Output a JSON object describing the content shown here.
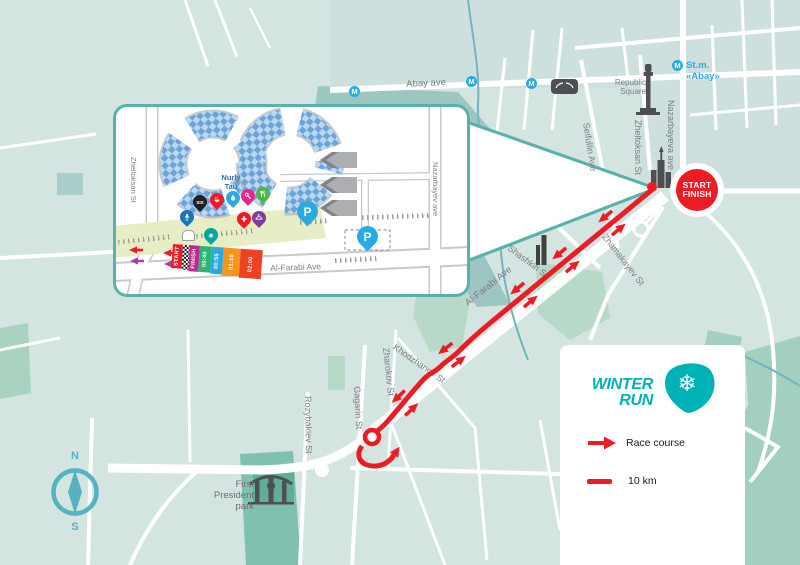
{
  "title": "Winter Run race course map",
  "colors": {
    "map_base": "#d3e4e1",
    "map_block": "#cde0dd",
    "lake": "#9dc5c2",
    "park_light_green": "#b7d9c8",
    "park_green": "#a3cfbf",
    "president_park": "#7fc1ae",
    "road": "#ffffff",
    "river": "#74b4c0",
    "inset_border_teal": "#57b2ad",
    "course_red": "#ed1c24",
    "magenta_arrow": "#b03e97",
    "metro_blue": "#29abe2",
    "street_label_gray": "#7c7d80",
    "building_gray": "#4d4f52",
    "winter_run_teal": "#00b1b6",
    "compass_teal": "#55b2c1",
    "nurly_tau_blue": "#6fa3d8",
    "start_zone_green": "#e7eec6"
  },
  "map": {
    "metro_letter": "M",
    "metro_station_label": "St.m. «Abay»",
    "labels": {
      "abay_ave": "Abay ave",
      "republic_square_line1": "Republic",
      "republic_square_line2": "Square",
      "nazarbayeva_ave": "Nazarbayeva ave",
      "zheltoksan_st": "Zheltoksan St",
      "seifullin_ave": "Seifullin Ave",
      "shashkin_st": "Shashkin St",
      "zhamakayev_st": "Zhamakayev St",
      "al_farabi_ave": "Al-Farabi Ave",
      "khodzhanov_st": "Khodzhanov St",
      "zharokov_st": "Zharokov St",
      "gagarin_st": "Gagarin St",
      "rozybakiev_st": "Rozybakiev St",
      "park_line1": "First",
      "park_line2": "President",
      "park_line3": "park"
    },
    "start_finish": {
      "line1": "START",
      "line2": "FINISH"
    },
    "compass": {
      "north": "N",
      "south": "S"
    }
  },
  "inset": {
    "labels": {
      "nurly_tau_line1": "Nurly",
      "nurly_tau_line2": "Tau",
      "zheltoksan_st": "Zheltoksan St",
      "nazarbayev_ave": "Nazarbayev ave",
      "al_farabi_ave": "Al-Farabi Ave"
    },
    "corrals": [
      {
        "label": "START",
        "color": "#ed1c24"
      },
      {
        "label": "",
        "color": "checkered"
      },
      {
        "label": "FINISH",
        "color": "#c0278f"
      },
      {
        "label": "00:40",
        "color": "#2bb673"
      },
      {
        "label": "00:55",
        "color": "#29abe2"
      },
      {
        "label": "01:10",
        "color": "#f7941e"
      },
      {
        "label": "02:00",
        "color": "#ef4123"
      }
    ],
    "pins": [
      {
        "icon": "announcer-icon",
        "color": "#1b75bb"
      },
      {
        "icon": "sis-point-icon",
        "color": "#231f20",
        "text": "SIS"
      },
      {
        "icon": "food-point-icon",
        "color": "#ed1c24"
      },
      {
        "icon": "water-point-icon",
        "color": "#29abe2"
      },
      {
        "icon": "key-icon",
        "color": "#ec268f"
      },
      {
        "icon": "meal-icon",
        "color": "#4cb748"
      },
      {
        "icon": "first-aid-icon",
        "color": "#ed1c24"
      },
      {
        "icon": "wardrobe-icon",
        "color": "#7e3f98"
      },
      {
        "icon": "bell-icon",
        "color": "#00a79d"
      }
    ],
    "parking_label": "P"
  },
  "legend": {
    "logo_line1": "WINTER",
    "logo_line2": "RUN",
    "snowflake_char": "❄",
    "items": [
      {
        "icon": "race-arrow",
        "label": "Race course"
      },
      {
        "icon": "distance-line",
        "label": "10 km"
      }
    ]
  }
}
